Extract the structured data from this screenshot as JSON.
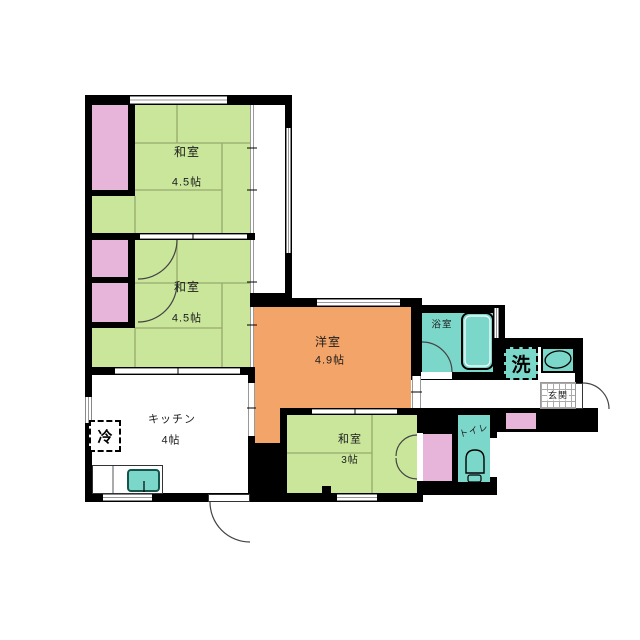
{
  "plan_title": "apartment-floor-plan",
  "rooms": {
    "washitsu1": {
      "name": "和室",
      "size": "4.5帖"
    },
    "washitsu2": {
      "name": "和室",
      "size": "4.5帖"
    },
    "youshitsu": {
      "name": "洋室",
      "size": "4.9帖"
    },
    "kitchen": {
      "name": "キッチン",
      "size": "4帖"
    },
    "washitsu3": {
      "name": "和室",
      "size": "3帖"
    },
    "bathroom": {
      "name": "浴室"
    },
    "toilet": {
      "name": "トイレ"
    },
    "entrance": {
      "name": "玄関"
    },
    "laundry": {
      "name": "洗"
    },
    "refrigerator": {
      "name": "冷"
    }
  },
  "colors": {
    "tatami_green": "#c9e69b",
    "closet_pink": "#e8b5da",
    "western_orange": "#f3a469",
    "wet_area_teal": "#7cd7cb",
    "wall_black": "#000000",
    "tatami_line": "#96aa6d"
  }
}
